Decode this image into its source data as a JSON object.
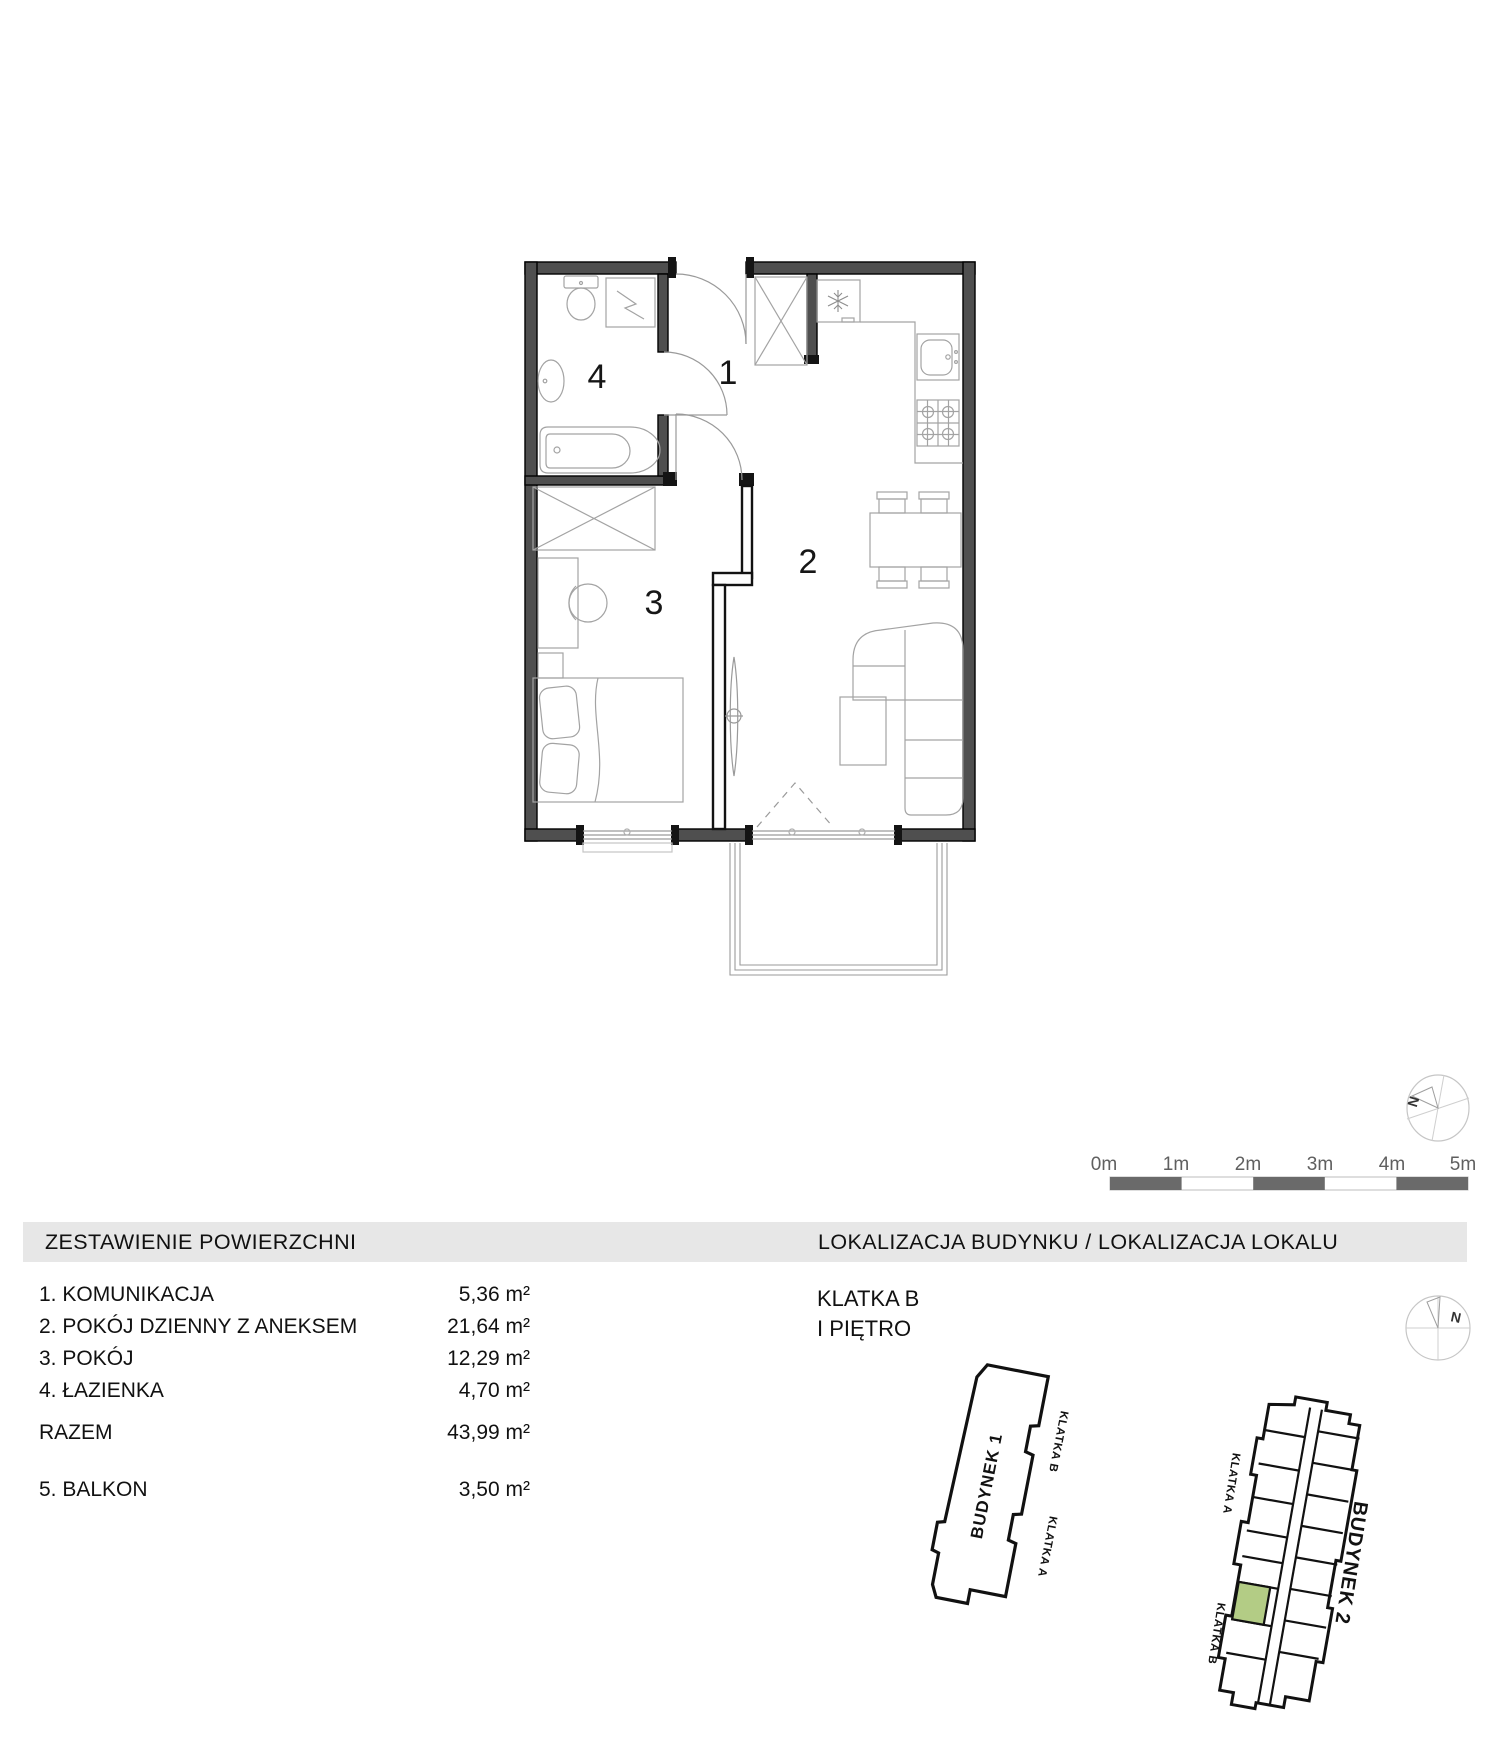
{
  "floor_plan": {
    "rooms": [
      {
        "number": "1"
      },
      {
        "number": "2"
      },
      {
        "number": "3"
      },
      {
        "number": "4"
      }
    ]
  },
  "scale_bar": {
    "labels": [
      "0m",
      "1m",
      "2m",
      "3m",
      "4m",
      "5m"
    ]
  },
  "compass": {
    "north_label": "N"
  },
  "areas_panel": {
    "title": "ZESTAWIENIE POWIERZCHNI",
    "rows": [
      {
        "label": "1. KOMUNIKACJA",
        "value": "5,36 m²"
      },
      {
        "label": "2. POKÓJ DZIENNY Z ANEKSEM",
        "value": "21,64 m²"
      },
      {
        "label": "3. POKÓJ",
        "value": "12,29 m²"
      },
      {
        "label": "4. ŁAZIENKA",
        "value": "4,70 m²"
      }
    ],
    "total": {
      "label": "RAZEM",
      "value": "43,99 m²"
    },
    "balcony": {
      "label": "5. BALKON",
      "value": "3,50 m²"
    }
  },
  "location_panel": {
    "title": "LOKALIZACJA BUDYNKU / LOKALIZACJA LOKALU",
    "staircase": "KLATKA B",
    "floor": "I PIĘTRO",
    "building1": {
      "name": "BUDYNEK 1",
      "klatka_a": "KLATKA A",
      "klatka_b": "KLATKA B"
    },
    "building2": {
      "name": "BUDYNEK 2",
      "klatka_a": "KLATKA A",
      "klatka_b": "KLATKA B"
    },
    "highlight_color": "#b3cc85"
  }
}
